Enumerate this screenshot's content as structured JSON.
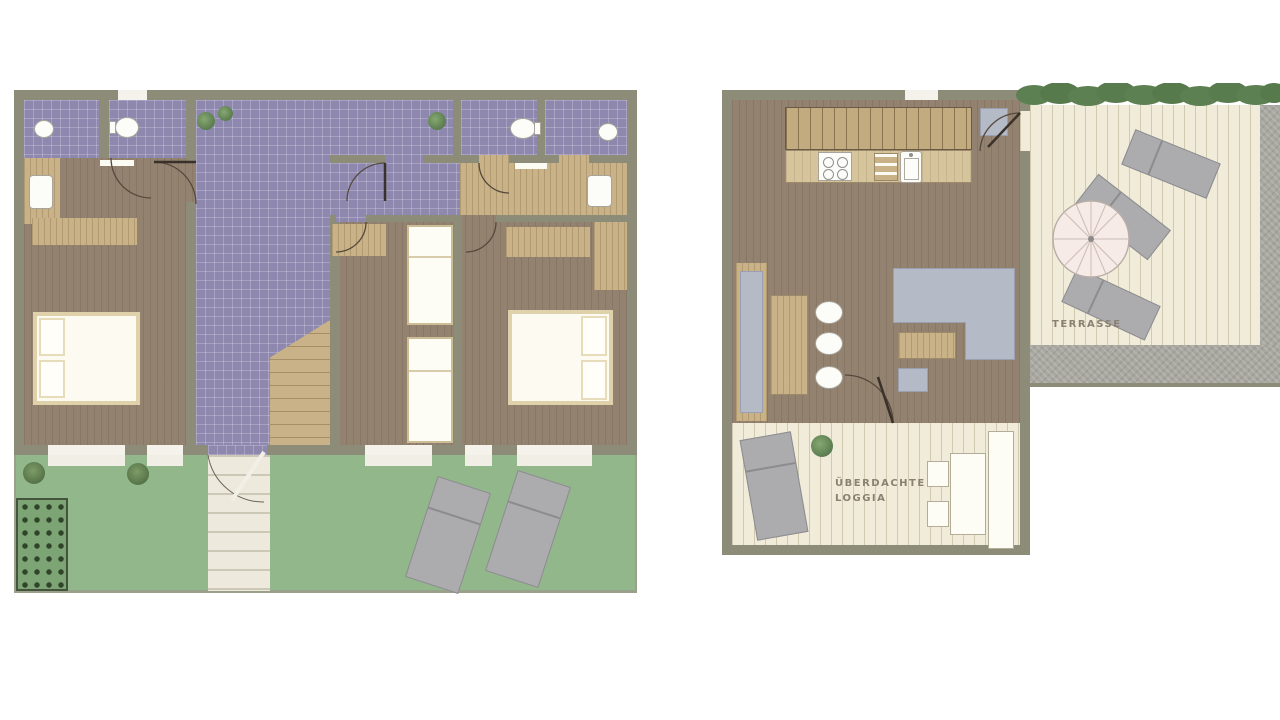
{
  "title": "apartment-floor-plans",
  "labels": {
    "terrace": "TERRASSE",
    "loggia_line1": "ÜBERDACHTE",
    "loggia_line2": "LOGGIA"
  },
  "palette": {
    "wall": "#8c8c79",
    "bathroom_tile": "#8e88af",
    "wood_floor": "#93826f",
    "light_wood": "#c9b287",
    "lawn": "#91b78b",
    "deck": "#f1ecd9",
    "stone_border": "#a8a7a0",
    "hedge": "#5d8052",
    "upholstery_gray": "#b5bac7",
    "lounger_gray": "#acacaf",
    "label_text": "#8a8172"
  },
  "plans": [
    {
      "id": "ground-floor",
      "features": [
        "bathroom-left",
        "bathroom-middle",
        "bathroom-right",
        "shower-room",
        "bedroom-left",
        "bedroom-middle-with-bunks",
        "bedroom-right",
        "tiled-hallway",
        "staircase",
        "garden-lawn",
        "garden-steps",
        "vegetable-patch",
        "two-sun-loungers",
        "bushes"
      ]
    },
    {
      "id": "upper-floor",
      "features": [
        "kitchen-counter",
        "hob",
        "sink",
        "door-mat",
        "dining-bench",
        "dining-table",
        "three-chairs",
        "corner-sofa",
        "coffee-table",
        "ottoman",
        "covered-loggia",
        "loggia-lounger",
        "loggia-table",
        "loggia-bench",
        "terrace-deck",
        "parasol",
        "three-sun-loungers",
        "hedge",
        "stone-border"
      ]
    }
  ]
}
